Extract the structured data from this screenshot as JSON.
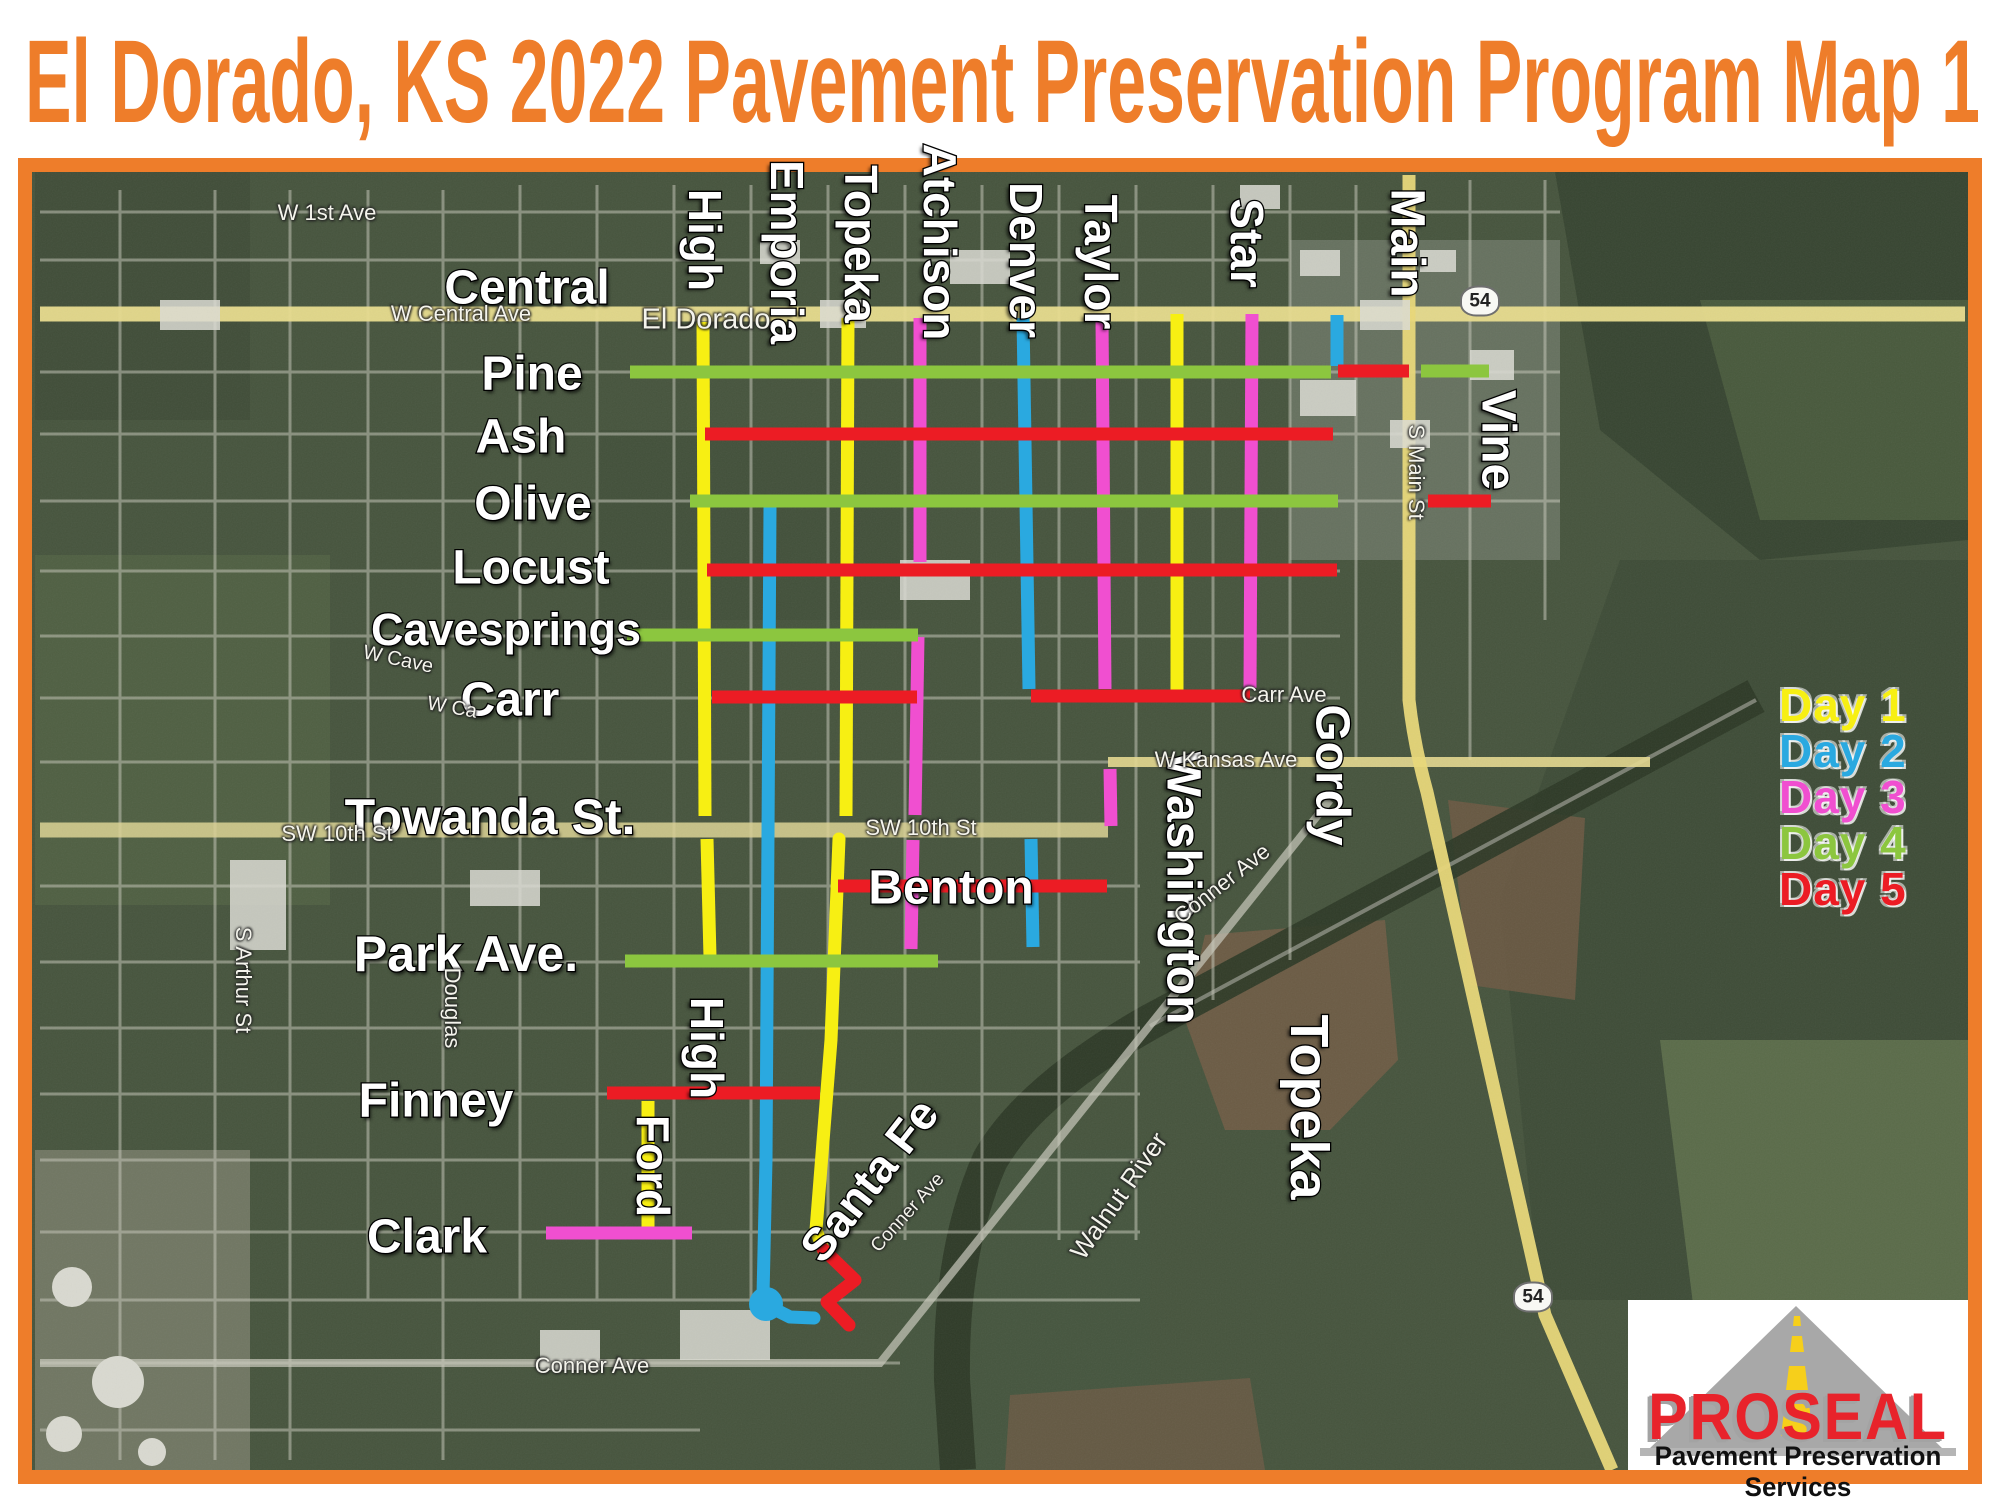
{
  "title": "El Dorado, KS  2022 Pavement Preservation Program Map 1",
  "colors": {
    "frame_orange": "#ee7d2a",
    "day1": "#f7ef13",
    "day2": "#2aa9e0",
    "day3": "#f04fd0",
    "day4": "#8cc63f",
    "day5": "#ec1c24",
    "map_background": "#46543d",
    "logo_red": "#e8232b"
  },
  "legend": {
    "items": [
      {
        "label": "Day 1",
        "color_key": "day1"
      },
      {
        "label": "Day 2",
        "color_key": "day2"
      },
      {
        "label": "Day 3",
        "color_key": "day3"
      },
      {
        "label": "Day 4",
        "color_key": "day4"
      },
      {
        "label": "Day 5",
        "color_key": "day5"
      }
    ]
  },
  "logo": {
    "name": "PROSEAL",
    "tagline": "Pavement Preservation Services"
  },
  "street_labels": [
    {
      "text": "Central",
      "x": 527,
      "y": 288,
      "rot": 0,
      "size": 48
    },
    {
      "text": "Pine",
      "x": 532,
      "y": 374,
      "rot": 0,
      "size": 48
    },
    {
      "text": "Ash",
      "x": 521,
      "y": 437,
      "rot": 0,
      "size": 48
    },
    {
      "text": "Olive",
      "x": 533,
      "y": 504,
      "rot": 0,
      "size": 48
    },
    {
      "text": "Locust",
      "x": 531,
      "y": 568,
      "rot": 0,
      "size": 48
    },
    {
      "text": "Cavesprings",
      "x": 506,
      "y": 630,
      "rot": 0,
      "size": 45
    },
    {
      "text": "Carr",
      "x": 510,
      "y": 700,
      "rot": 0,
      "size": 48
    },
    {
      "text": "Towanda St.",
      "x": 490,
      "y": 817,
      "rot": 0,
      "size": 50
    },
    {
      "text": "Benton",
      "x": 951,
      "y": 888,
      "rot": 0,
      "size": 48
    },
    {
      "text": "Park Ave.",
      "x": 466,
      "y": 954,
      "rot": 0,
      "size": 50
    },
    {
      "text": "Finney",
      "x": 436,
      "y": 1101,
      "rot": 0,
      "size": 48
    },
    {
      "text": "Clark",
      "x": 427,
      "y": 1237,
      "rot": 0,
      "size": 48
    },
    {
      "text": "High",
      "x": 705,
      "y": 240,
      "rot": 90,
      "size": 46
    },
    {
      "text": "Emporia",
      "x": 787,
      "y": 252,
      "rot": 90,
      "size": 46
    },
    {
      "text": "Topeka",
      "x": 861,
      "y": 244,
      "rot": 90,
      "size": 46
    },
    {
      "text": "Atchison",
      "x": 940,
      "y": 242,
      "rot": 90,
      "size": 46
    },
    {
      "text": "Denver",
      "x": 1026,
      "y": 260,
      "rot": 90,
      "size": 46
    },
    {
      "text": "Taylor",
      "x": 1101,
      "y": 262,
      "rot": 90,
      "size": 46
    },
    {
      "text": "Star",
      "x": 1247,
      "y": 243,
      "rot": 90,
      "size": 46
    },
    {
      "text": "Main",
      "x": 1407,
      "y": 243,
      "rot": 90,
      "size": 48
    },
    {
      "text": "Vine",
      "x": 1498,
      "y": 440,
      "rot": 90,
      "size": 48
    },
    {
      "text": "Gordy",
      "x": 1332,
      "y": 775,
      "rot": 90,
      "size": 48
    },
    {
      "text": "Washington",
      "x": 1183,
      "y": 888,
      "rot": 90,
      "size": 48
    },
    {
      "text": "High",
      "x": 707,
      "y": 1048,
      "rot": 90,
      "size": 46
    },
    {
      "text": "Ford",
      "x": 653,
      "y": 1166,
      "rot": 90,
      "size": 46
    },
    {
      "text": "Topeka",
      "x": 1309,
      "y": 1107,
      "rot": 90,
      "size": 54
    },
    {
      "text": "Santa Fe",
      "x": 869,
      "y": 1180,
      "rot": -52,
      "size": 46
    }
  ],
  "small_labels": [
    {
      "text": "W 1st Ave",
      "x": 327,
      "y": 213,
      "rot": 0,
      "size": 22
    },
    {
      "text": "W Central Ave",
      "x": 461,
      "y": 314,
      "rot": 0,
      "size": 22
    },
    {
      "text": "El Dorado",
      "x": 706,
      "y": 320,
      "rot": 0,
      "size": 29
    },
    {
      "text": "S Main St",
      "x": 1416,
      "y": 472,
      "rot": 90,
      "size": 22
    },
    {
      "text": "W Kansas Ave",
      "x": 1226,
      "y": 760,
      "rot": 0,
      "size": 22
    },
    {
      "text": "SW 10th St",
      "x": 337,
      "y": 834,
      "rot": 0,
      "size": 22
    },
    {
      "text": "SW 10th St",
      "x": 921,
      "y": 828,
      "rot": 0,
      "size": 22
    },
    {
      "text": "Carr Ave",
      "x": 1284,
      "y": 695,
      "rot": 0,
      "size": 22
    },
    {
      "text": "Conner Ave",
      "x": 592,
      "y": 1366,
      "rot": 0,
      "size": 22
    },
    {
      "text": "Conner Ave",
      "x": 1222,
      "y": 884,
      "rot": -38,
      "size": 22
    },
    {
      "text": "Conner Ave",
      "x": 908,
      "y": 1213,
      "rot": -48,
      "size": 19
    },
    {
      "text": "W Cave",
      "x": 398,
      "y": 660,
      "rot": 12,
      "size": 20
    },
    {
      "text": "W Ca",
      "x": 452,
      "y": 708,
      "rot": 10,
      "size": 20
    },
    {
      "text": "S Arthur St",
      "x": 243,
      "y": 980,
      "rot": 90,
      "size": 22
    },
    {
      "text": "Douglas",
      "x": 452,
      "y": 1008,
      "rot": 90,
      "size": 22
    },
    {
      "text": "Walnut River",
      "x": 1119,
      "y": 1196,
      "rot": -55,
      "size": 26
    }
  ],
  "shields": [
    {
      "text": "54",
      "x": 1480,
      "y": 301
    },
    {
      "text": "54",
      "x": 1533,
      "y": 1297
    }
  ],
  "segments": [
    {
      "street": "High (north)",
      "day": 1,
      "pts": [
        [
          703,
          322
        ],
        [
          705,
          816
        ]
      ]
    },
    {
      "street": "High (south)",
      "day": 1,
      "pts": [
        [
          707,
          839
        ],
        [
          710,
          957
        ]
      ]
    },
    {
      "street": "Topeka (north)",
      "day": 1,
      "pts": [
        [
          848,
          318
        ],
        [
          846,
          816
        ]
      ]
    },
    {
      "street": "Topeka (south)",
      "day": 1,
      "pts": [
        [
          839,
          839
        ],
        [
          831,
          1040
        ],
        [
          816,
          1230
        ],
        [
          823,
          1249
        ]
      ],
      "cap": "round"
    },
    {
      "street": "between Taylor and Star",
      "day": 1,
      "pts": [
        [
          1177,
          314
        ],
        [
          1177,
          691
        ]
      ]
    },
    {
      "street": "Ford",
      "day": 1,
      "pts": [
        [
          648,
          1101
        ],
        [
          648,
          1230
        ]
      ]
    },
    {
      "street": "Emporia",
      "day": 2,
      "pts": [
        [
          770,
          508
        ],
        [
          766,
          1160
        ],
        [
          763,
          1296
        ]
      ],
      "cap": "round"
    },
    {
      "street": "Emporia hook",
      "day": 2,
      "pts": [
        [
          766,
          1305
        ],
        [
          790,
          1317
        ],
        [
          814,
          1318
        ]
      ],
      "cap": "round"
    },
    {
      "street": "Denver (north)",
      "day": 2,
      "pts": [
        [
          1023,
          318
        ],
        [
          1029,
          689
        ]
      ]
    },
    {
      "street": "Denver (south)",
      "day": 2,
      "pts": [
        [
          1031,
          839
        ],
        [
          1033,
          947
        ]
      ]
    },
    {
      "street": "Gordy north stub",
      "day": 2,
      "pts": [
        [
          1337,
          315
        ],
        [
          1337,
          366
        ]
      ]
    },
    {
      "street": "Atchison (north)",
      "day": 3,
      "pts": [
        [
          920,
          318
        ],
        [
          920,
          562
        ]
      ]
    },
    {
      "street": "Atchison (mid)",
      "day": 3,
      "pts": [
        [
          918,
          637
        ],
        [
          915,
          815
        ]
      ]
    },
    {
      "street": "Atchison (south)",
      "day": 3,
      "pts": [
        [
          913,
          840
        ],
        [
          911,
          949
        ]
      ]
    },
    {
      "street": "Taylor",
      "day": 3,
      "pts": [
        [
          1102,
          318
        ],
        [
          1105,
          689
        ]
      ]
    },
    {
      "street": "Taylor stub",
      "day": 3,
      "pts": [
        [
          1110,
          769
        ],
        [
          1111,
          826
        ]
      ]
    },
    {
      "street": "Star",
      "day": 3,
      "pts": [
        [
          1252,
          314
        ],
        [
          1250,
          688
        ]
      ]
    },
    {
      "street": "Clark",
      "day": 3,
      "pts": [
        [
          546,
          1233
        ],
        [
          692,
          1233
        ]
      ]
    },
    {
      "street": "Pine (west)",
      "day": 4,
      "pts": [
        [
          630,
          372
        ],
        [
          1331,
          372
        ]
      ]
    },
    {
      "street": "Pine (east)",
      "day": 4,
      "pts": [
        [
          1421,
          371
        ],
        [
          1489,
          371
        ]
      ]
    },
    {
      "street": "Olive",
      "day": 4,
      "pts": [
        [
          690,
          501
        ],
        [
          1338,
          501
        ]
      ]
    },
    {
      "street": "Cavesprings",
      "day": 4,
      "pts": [
        [
          627,
          635
        ],
        [
          918,
          635
        ]
      ]
    },
    {
      "street": "Park Ave",
      "day": 4,
      "pts": [
        [
          625,
          961
        ],
        [
          938,
          961
        ]
      ]
    },
    {
      "street": "Ash",
      "day": 5,
      "pts": [
        [
          705,
          434
        ],
        [
          1333,
          434
        ]
      ]
    },
    {
      "street": "Locust",
      "day": 5,
      "pts": [
        [
          707,
          570
        ],
        [
          1337,
          570
        ]
      ]
    },
    {
      "street": "Carr (west)",
      "day": 5,
      "pts": [
        [
          712,
          697
        ],
        [
          917,
          697
        ]
      ]
    },
    {
      "street": "Carr (east)",
      "day": 5,
      "pts": [
        [
          1031,
          696
        ],
        [
          1250,
          696
        ]
      ]
    },
    {
      "street": "Pine at Main",
      "day": 5,
      "pts": [
        [
          1338,
          371
        ],
        [
          1409,
          371
        ]
      ]
    },
    {
      "street": "Olive east of Main",
      "day": 5,
      "pts": [
        [
          1428,
          501
        ],
        [
          1491,
          501
        ]
      ]
    },
    {
      "street": "Benton",
      "day": 5,
      "pts": [
        [
          838,
          886
        ],
        [
          1107,
          886
        ]
      ]
    },
    {
      "street": "Finney",
      "day": 5,
      "pts": [
        [
          607,
          1093
        ],
        [
          820,
          1093
        ]
      ]
    },
    {
      "street": "Santa Fe elbow",
      "day": 5,
      "pts": [
        [
          823,
          1249
        ],
        [
          855,
          1280
        ],
        [
          827,
          1302
        ],
        [
          849,
          1325
        ]
      ],
      "cap": "round"
    }
  ],
  "dots": [
    {
      "day": 2,
      "x": 766,
      "y": 1304,
      "r": 17
    }
  ]
}
